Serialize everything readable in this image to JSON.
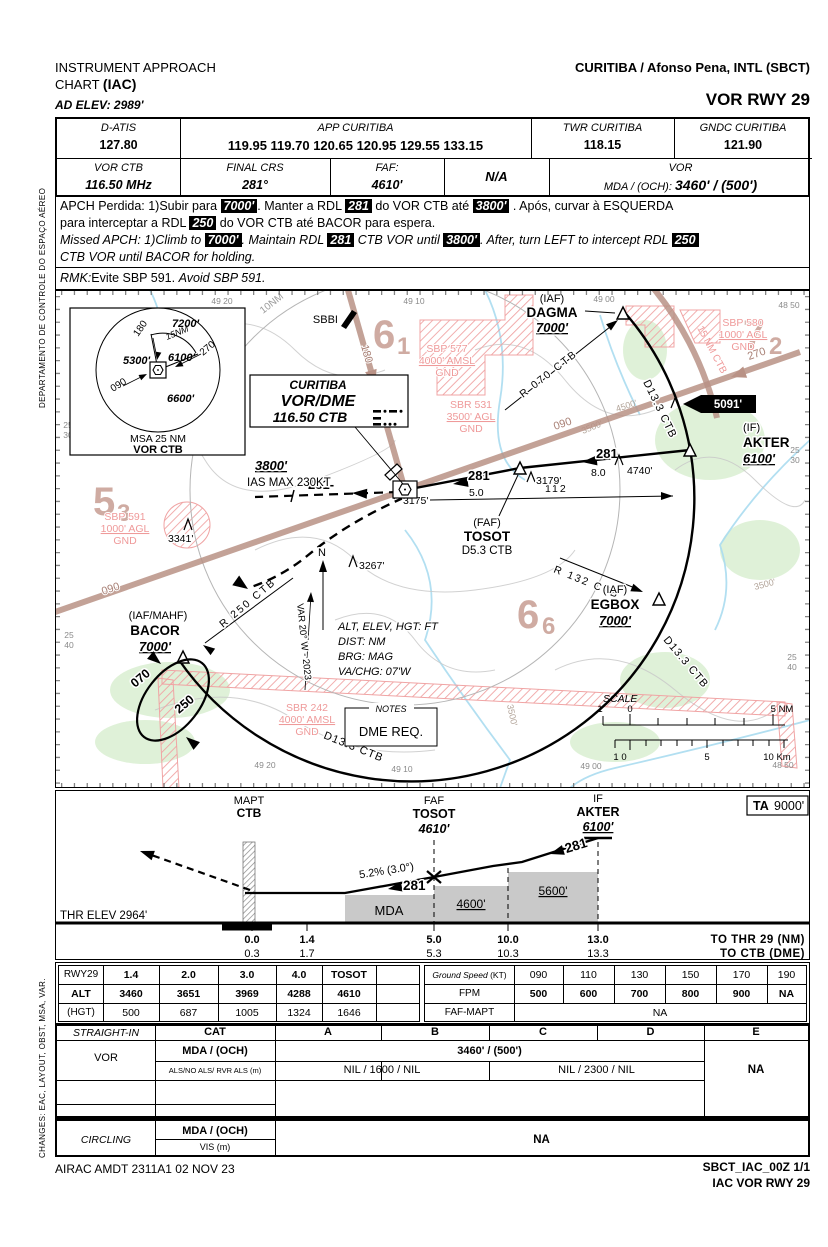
{
  "colors": {
    "brown": "#b99286",
    "pink": "#ef9a9a",
    "water": "#aadcf0",
    "green": "#dcf0d4",
    "contour": "#c9c9c9",
    "faded": "#c79d92",
    "block_gray": "#c9c9c9",
    "accent_black": "#000000"
  },
  "sidebar": {
    "top": "DEPARTAMENTO DE CONTROLE DO ESPAÇO AÉREO",
    "bottom": "CHANGES: EAC, LAYOUT, OBST, MSA, VAR."
  },
  "header": {
    "title1": "INSTRUMENT APPROACH",
    "title2a": "CHART ",
    "title2b": "(IAC)",
    "ad_elev": "AD ELEV: 2989'",
    "airport": "CURITIBA / Afonso Pena, INTL (SBCT)",
    "procedure": "VOR RWY 29"
  },
  "comms": {
    "datis_label": "D-ATIS",
    "datis": "127.80",
    "app_label": "APP CURITIBA",
    "app": "119.95 119.70 120.65 120.95 129.55 133.15",
    "twr_label": "TWR CURITIBA",
    "twr": "118.15",
    "gnd_label": "GNDC CURITIBA",
    "gnd": "121.90"
  },
  "proc_row": {
    "vor_label": "VOR CTB",
    "vor": "116.50 MHz",
    "crs_label": "FINAL CRS",
    "crs": "281°",
    "faf_label": "FAF:",
    "faf": "4610'",
    "na": "N/A",
    "vor2": "VOR",
    "mda_prefix": "MDA / (OCH):",
    "mda": "3460' / (500')"
  },
  "missed": {
    "pt1a": "APCH Perdida: 1)Subir para ",
    "hl1": "7000'",
    "pt1b": ". Manter a RDL ",
    "hl2": "281",
    "pt1c": " do VOR CTB até ",
    "hl3": "3800'",
    "pt1d": " . Após, curvar à ESQUERDA",
    "pt2a": "para interceptar a RDL ",
    "hl4": "250",
    "pt2b": " do VOR CTB até BACOR para espera.",
    "en1a": "Missed APCH: 1)Climb to ",
    "hl5": "7000'",
    "en1b": ". Maintain RDL ",
    "hl6": "281",
    "en1c": " CTB VOR until ",
    "hl7": "3800'",
    "en1d": ". After, turn LEFT to intercept RDL ",
    "hl8": "250",
    "en2": "CTB VOR until BACOR for holding."
  },
  "rmk": {
    "label": "RMK:",
    "pt": "Evite SBP 591. ",
    "en": "Avoid SBP 591."
  },
  "msa": {
    "s7200": "7200'",
    "b180": "180",
    "r15": "15NM",
    "s5300": "5300'",
    "s6100": "6100'",
    "b270": "270",
    "b090": "090",
    "s6600": "6600'",
    "title": "MSA 25 NM",
    "station": "VOR CTB"
  },
  "vorbox": {
    "city": "CURITIBA",
    "type": "VOR/DME",
    "freq": "116.50  CTB"
  },
  "plan": {
    "grid": {
      "top": [
        "49 20",
        "49 10",
        "49 00",
        "48 50"
      ],
      "bottom": [
        "49 20",
        "49 10",
        "49 00",
        "48 50"
      ],
      "left": [
        [
          "25",
          "30"
        ],
        [
          "25",
          "40"
        ]
      ],
      "right": [
        [
          "25",
          "30"
        ],
        [
          "25",
          "40"
        ]
      ]
    },
    "big": [
      [
        "6",
        "1"
      ],
      [
        "7",
        "2"
      ],
      [
        "5",
        "3"
      ],
      [
        "6",
        "6"
      ]
    ],
    "wpt": {
      "dagma_t": "(IAF)",
      "dagma_n": "DAGMA",
      "dagma_a": "7000'",
      "akter_t": "(IF)",
      "akter_n": "AKTER",
      "akter_a": "6100'",
      "egbox_t": "(IAF)",
      "egbox_n": "EGBOX",
      "egbox_a": "7000'",
      "bacor_t": "(IAF/MAHF)",
      "bacor_n": "BACOR",
      "bacor_a": "7000'",
      "tosot_t": "(FAF)",
      "tosot_n": "TOSOT",
      "tosot_d": "D5.3 CTB"
    },
    "obs": {
      "a": "3341'",
      "b": "3267'",
      "c": "3175'",
      "d": "3179'",
      "e": "4740'",
      "high": "5091'"
    },
    "res": {
      "sbp591": [
        "SBP 591",
        "1000' AGL",
        "GND"
      ],
      "sbp577": [
        "SBP 577",
        "4000' AMSL",
        "GND"
      ],
      "sbr531": [
        "SBR 531",
        "3500' AGL",
        "GND"
      ],
      "sbp580": [
        "SBP 580",
        "1000' AGL",
        "GND"
      ],
      "sbr242": [
        "SBR 242",
        "4000' AMSL",
        "GND"
      ]
    },
    "labels": {
      "ring10": "10NM",
      "sbbi": "SBBI",
      "crs180": "180",
      "crs090": "090",
      "crs270": "270",
      "arc15": "15 NM CTB",
      "arc": "D13.3 CTB",
      "r070": "R 070 CTB",
      "r132": "R 132 CTB",
      "r250": "R 250 CTB",
      "crs281": "281",
      "crs281d": "281-",
      "d50": "5.0",
      "d80": "8.0",
      "r112": "112",
      "alt3800": "3800'",
      "ias": "IAS MAX 230KT",
      "north": "N",
      "var": "VAR 20° W - 2023",
      "legend": [
        "ALT, ELEV, HGT: FT",
        "DIST: NM",
        "BRG: MAG",
        "VA/CHG: 07'W"
      ],
      "notes_title": "NOTES",
      "notes_text": "DME REQ.",
      "scale_title": "SCALE",
      "hold_in": "070",
      "hold_out": "250",
      "c4500": "4500'",
      "c3500": "3500'"
    },
    "scalebar": {
      "nm1": "1",
      "nm0": "0",
      "nm5": "5 NM",
      "km1": "1 0",
      "km5": "5",
      "km10": "10 Km"
    }
  },
  "profile": {
    "ta_label": "TA",
    "ta_value": "9000'",
    "mapt1": "MAPT",
    "mapt2": "CTB",
    "faf1": "FAF",
    "faf2": "TOSOT",
    "faf3": "4610'",
    "if1": "IF",
    "if2": "AKTER",
    "if3": "6100'",
    "grad": "5.2% (3.0°)",
    "crs": "281",
    "mda": "MDA",
    "b4600": "4600'",
    "b5600": "5600'",
    "thr": "THR ELEV 2964'",
    "nm": [
      "0.0",
      "1.4",
      "5.0",
      "10.0",
      "13.0"
    ],
    "nm_label": "TO THR 29 (NM)",
    "dme": [
      "0.3",
      "1.7",
      "5.3",
      "10.3",
      "13.3"
    ],
    "dme_label": "TO CTB (DME)"
  },
  "descent": {
    "left": [
      [
        "RWY29",
        "1.4",
        "2.0",
        "3.0",
        "4.0",
        "TOSOT"
      ],
      [
        "ALT",
        "3460",
        "3651",
        "3969",
        "4288",
        "4610"
      ],
      [
        "(HGT)",
        "500",
        "687",
        "1005",
        "1324",
        "1646"
      ]
    ],
    "right": {
      "gs_label": "Ground Speed",
      "gs_unit": "(KT)",
      "gs": [
        "090",
        "110",
        "130",
        "150",
        "170",
        "190"
      ],
      "fpm_label": "FPM",
      "fpm": [
        "500",
        "600",
        "700",
        "800",
        "900",
        "NA"
      ],
      "fm_label": "FAF-MAPT",
      "fm_value": "NA"
    }
  },
  "minimums": {
    "straight": "STRAIGHT-IN",
    "cat": "CAT",
    "cats": [
      "A",
      "B",
      "C",
      "D",
      "E"
    ],
    "vor": "VOR",
    "mda_label": "MDA / (OCH)",
    "mda": "3460' / (500')",
    "als_label": "ALS/NO ALS/ RVR ALS (m)",
    "als_ab": "NIL / 1600 / NIL",
    "als_cd": "NIL / 2300 / NIL",
    "na_e": "NA",
    "circling": "CIRCLING",
    "cmda": "MDA / (OCH)",
    "vis": "VIS (m)",
    "cna": "NA"
  },
  "footer": {
    "airac": "AIRAC AMDT 2311A1  02 NOV 23",
    "chart_id": "SBCT_IAC_00Z 1/1",
    "chart_name": "IAC VOR RWY 29"
  }
}
